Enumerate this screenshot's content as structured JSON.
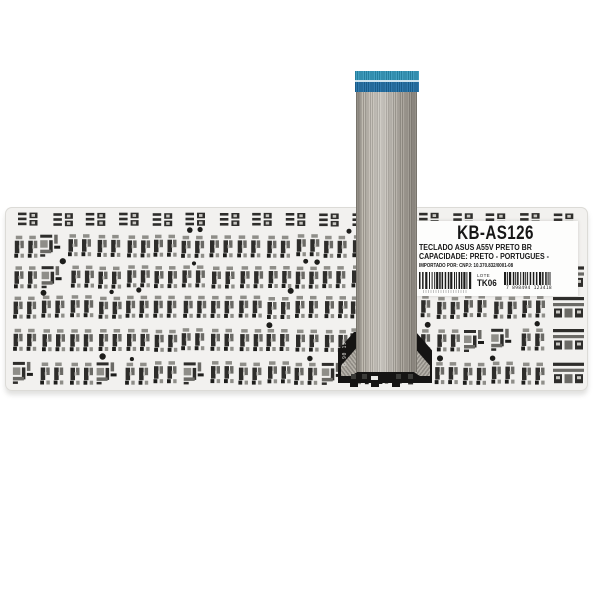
{
  "label": {
    "model": "KB-AS126",
    "line1": "TECLADO ASUS A55V PRETO BR",
    "line2": "CAPACIDADE: PRETO - PORTUGUES -",
    "line3": "IMPORTADO POR: CNPJ: 10.370.832/0001-08",
    "lote_label": "LOTE",
    "lote_value": "TK06",
    "barcode_right_digits": "7 898494 123418",
    "barcode_color": "#1c1c1b"
  },
  "connector": {
    "marking": "B 90 19",
    "color": "#151413"
  },
  "cable": {
    "tip_top_color": "#2c93b8",
    "tip_bottom_color": "#1d6da4",
    "body_color": "#b1ada4"
  },
  "keyboard": {
    "plate_color": "#f2f1ef",
    "glyph_dark": "#2e2d2b",
    "glyph_dark2": "#1d1d1b",
    "glyph_mid": "#8f8e89",
    "glyph_mid2": "#6b6a66",
    "glyph_light": "#c9c8c3"
  }
}
